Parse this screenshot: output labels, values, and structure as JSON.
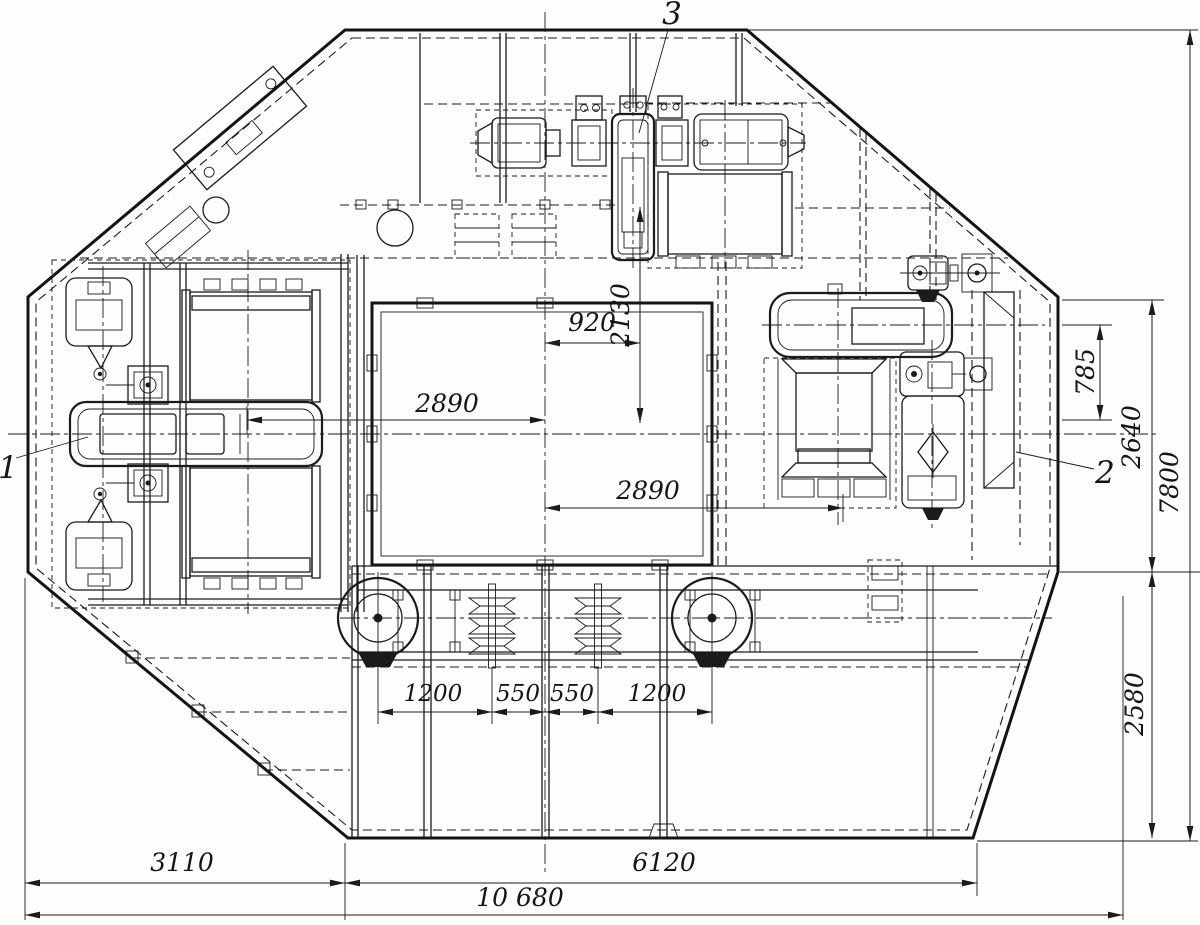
{
  "drawing": {
    "background": "#fdfdfb",
    "ink": "#1b1b1b",
    "dims": {
      "w920": "920",
      "h2130": "2130",
      "w2890_upper": "2890",
      "w2890_lower": "2890",
      "h785": "785",
      "h2640": "2640",
      "h7800": "7800",
      "h2580": "2580",
      "s1200_left": "1200",
      "s550_left": "550",
      "s550_right": "550",
      "s1200_right": "1200",
      "w3110": "3110",
      "w6120": "6120",
      "w10680": "10 680"
    },
    "callouts": {
      "item1": "1",
      "item2": "2",
      "item3": "3"
    }
  }
}
